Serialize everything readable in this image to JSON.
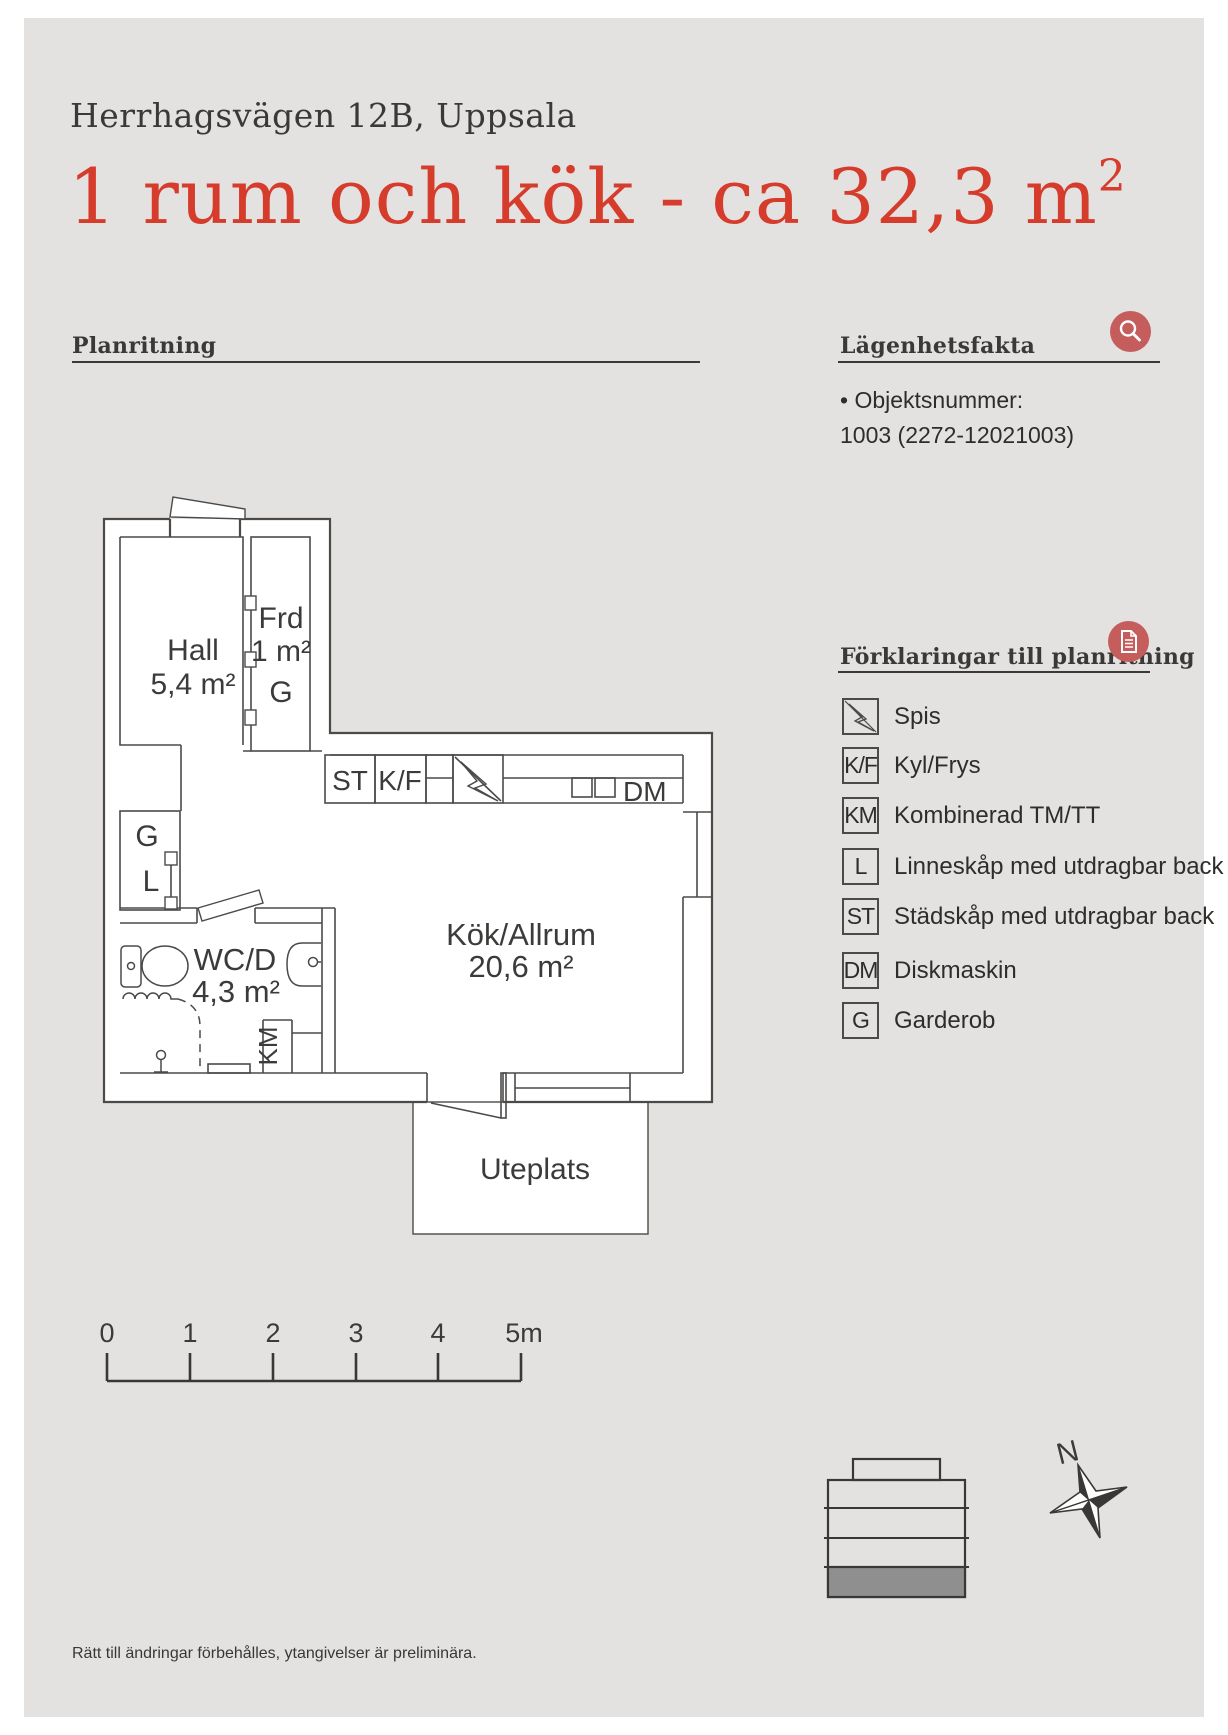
{
  "header": {
    "address": "Herrhagsvägen 12B, Uppsala",
    "title": "1 rum och kök - ca 32,3 m",
    "title_sup": "2"
  },
  "sections": {
    "plan": {
      "label": "Planritning"
    },
    "facts": {
      "label": "Lägenhetsfakta",
      "item_label": "• Objektsnummer:",
      "item_value": "1003 (2272-12021003)"
    },
    "legend": {
      "label": "Förklaringar till planritning",
      "items": [
        {
          "box": "",
          "icon": "stove-bolt-icon",
          "label": "Spis"
        },
        {
          "box": "K/F",
          "label": "Kyl/Frys"
        },
        {
          "box": "KM",
          "label": "Kombinerad TM/TT"
        },
        {
          "box": "L",
          "label": "Linneskåp med utdragbar back"
        },
        {
          "box": "ST",
          "label": "Städskåp med utdragbar back"
        },
        {
          "box": "DM",
          "label": "Diskmaskin"
        },
        {
          "box": "G",
          "label": "Garderob"
        }
      ]
    }
  },
  "floorplan": {
    "rooms": {
      "hall": {
        "name": "Hall",
        "area": "5,4 m²"
      },
      "frd": {
        "name": "Frd",
        "area": "1 m²",
        "g": "G"
      },
      "closet": {
        "g": "G",
        "l": "L"
      },
      "wc": {
        "name": "WC/D",
        "area": "4,3 m²"
      },
      "livingkitchen": {
        "name": "Kök/Allrum",
        "area": "20,6 m²"
      },
      "uteplats": {
        "name": "Uteplats"
      }
    },
    "fixtures": {
      "st": "ST",
      "kf": "K/F",
      "dm": "DM",
      "km": "KM"
    }
  },
  "scalebar": {
    "labels": [
      "0",
      "1",
      "2",
      "3",
      "4",
      "5m"
    ]
  },
  "compass": {
    "north": "N"
  },
  "footer": {
    "text": "Rätt till ändringar förbehålles, ytangivelser är preliminära."
  },
  "colors": {
    "page_bg": "#e3e2e0",
    "accent_red": "#d63c2c",
    "icon_red": "#c65d5d",
    "ink": "#3d3b3a",
    "plan_line": "#4c4a48",
    "building_floor_fill": "#8f8f8f"
  }
}
